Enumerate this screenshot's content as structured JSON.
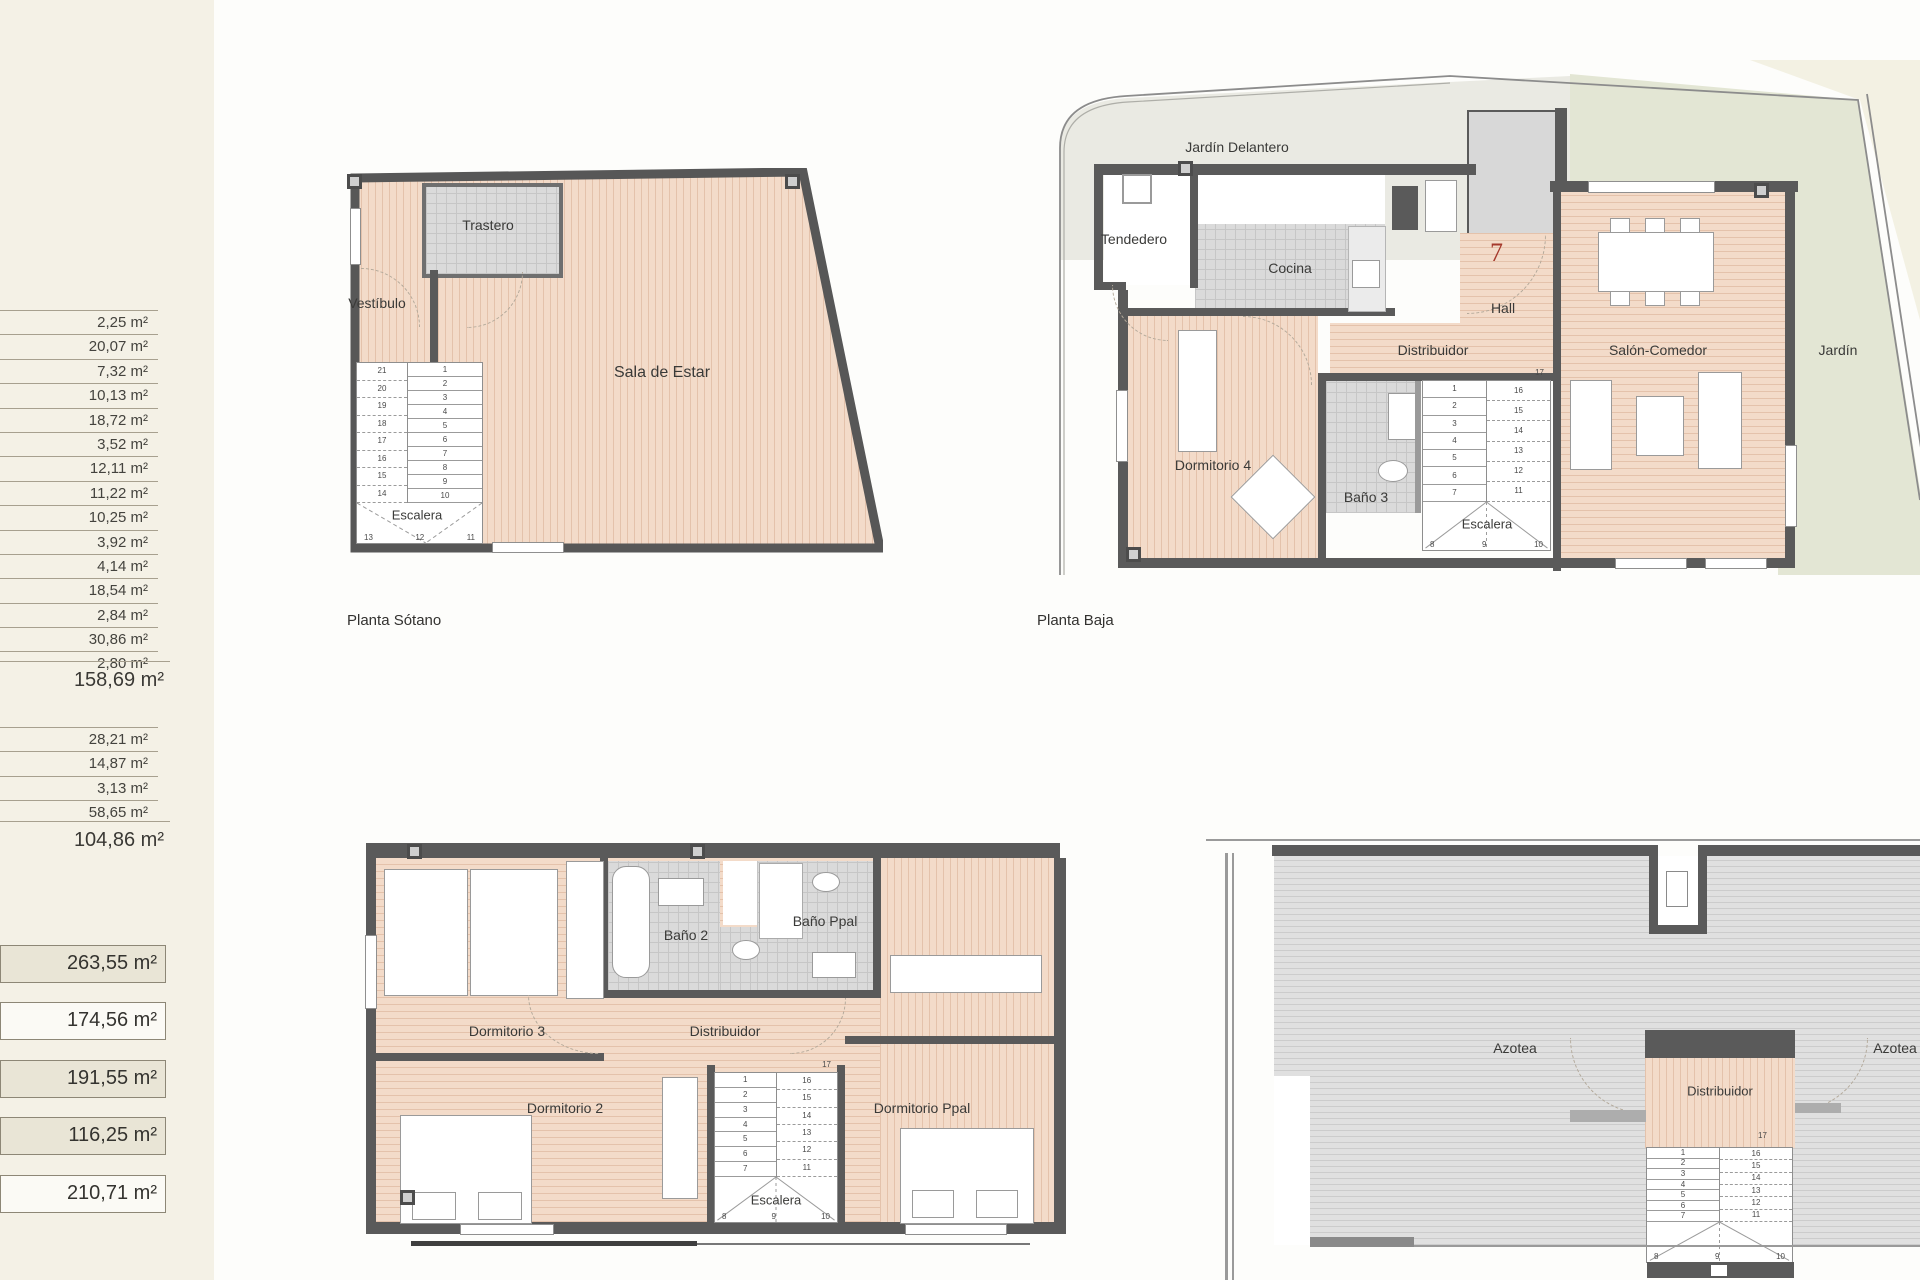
{
  "sidebar": {
    "group1": {
      "rows": [
        "2,25 m²",
        "20,07 m²",
        "7,32 m²",
        "10,13 m²",
        "18,72 m²",
        "3,52 m²",
        "12,11 m²",
        "11,22 m²",
        "10,25 m²",
        "3,92 m²",
        "4,14 m²",
        "18,54 m²",
        "2,84 m²",
        "30,86 m²",
        "2,80 m²"
      ],
      "total": "158,69 m²"
    },
    "group2": {
      "rows": [
        "28,21 m²",
        "14,87 m²",
        "3,13 m²",
        "58,65 m²"
      ],
      "total": "104,86 m²"
    },
    "boxes": [
      {
        "value": "263,55 m²",
        "filled": true
      },
      {
        "value": "174,56 m²",
        "filled": false
      },
      {
        "value": "191,55 m²",
        "filled": true
      },
      {
        "value": "116,25 m²",
        "filled": true
      },
      {
        "value": "210,71 m²",
        "filled": false
      }
    ]
  },
  "colors": {
    "wall": "#5a5a5a",
    "wood_floor": "#f3dbc9",
    "tile_floor": "#dadada",
    "roof": "#e0e0e0",
    "garden": "#e3e6d4",
    "front_garden": "#eaeae3",
    "unit_number_red": "#a5392c",
    "sidebar_beige": "#f4f1e6"
  },
  "plans": {
    "sotano": {
      "caption": "Planta Sótano",
      "trastero": "Trastero",
      "vestibulo": "Vestíbulo",
      "sala": "Sala de Estar",
      "escalera": "Escalera",
      "stairs": {
        "left": [
          "21",
          "20",
          "19",
          "18",
          "17",
          "16",
          "15",
          "14"
        ],
        "right": [
          "1",
          "2",
          "3",
          "4",
          "5",
          "6",
          "7",
          "8",
          "9",
          "10"
        ],
        "bottom": [
          "13",
          "12",
          "11"
        ]
      }
    },
    "baja": {
      "caption": "Planta Baja",
      "jardin_delantero": "Jardín Delantero",
      "tendedero": "Tendedero",
      "cocina": "Cocina",
      "unit_number": "7",
      "hall": "Hall",
      "distribuidor": "Distribuidor",
      "dormitorio4": "Dormitorio 4",
      "bano3": "Baño 3",
      "escalera": "Escalera",
      "salon": "Salón-Comedor",
      "jardin": "Jardín",
      "stairs": {
        "top": "17",
        "left": [
          "1",
          "2",
          "3",
          "4",
          "5",
          "6",
          "7"
        ],
        "right": [
          "16",
          "15",
          "14",
          "13",
          "12",
          "11"
        ],
        "bottom": [
          "8",
          "9",
          "10"
        ]
      }
    },
    "primera": {
      "dormitorio3": "Dormitorio 3",
      "bano2": "Baño 2",
      "bano_ppal": "Baño Ppal",
      "distribuidor": "Distribuidor",
      "dormitorio2": "Dormitorio 2",
      "dormitorio_ppal": "Dormitorio Ppal",
      "escalera": "Escalera",
      "stairs": {
        "top": "17",
        "left": [
          "1",
          "2",
          "3",
          "4",
          "5",
          "6",
          "7"
        ],
        "right": [
          "16",
          "15",
          "14",
          "13",
          "12",
          "11"
        ],
        "bottom": [
          "8",
          "9",
          "10"
        ]
      }
    },
    "azotea": {
      "azotea_left": "Azotea",
      "azotea_right": "Azotea",
      "distribuidor": "Distribuidor",
      "stairs": {
        "top": "17",
        "left": [
          "1",
          "2",
          "3",
          "4",
          "5",
          "6",
          "7"
        ],
        "right": [
          "16",
          "15",
          "14",
          "13",
          "12",
          "11"
        ],
        "bottom": [
          "8",
          "9",
          "10"
        ]
      }
    }
  }
}
